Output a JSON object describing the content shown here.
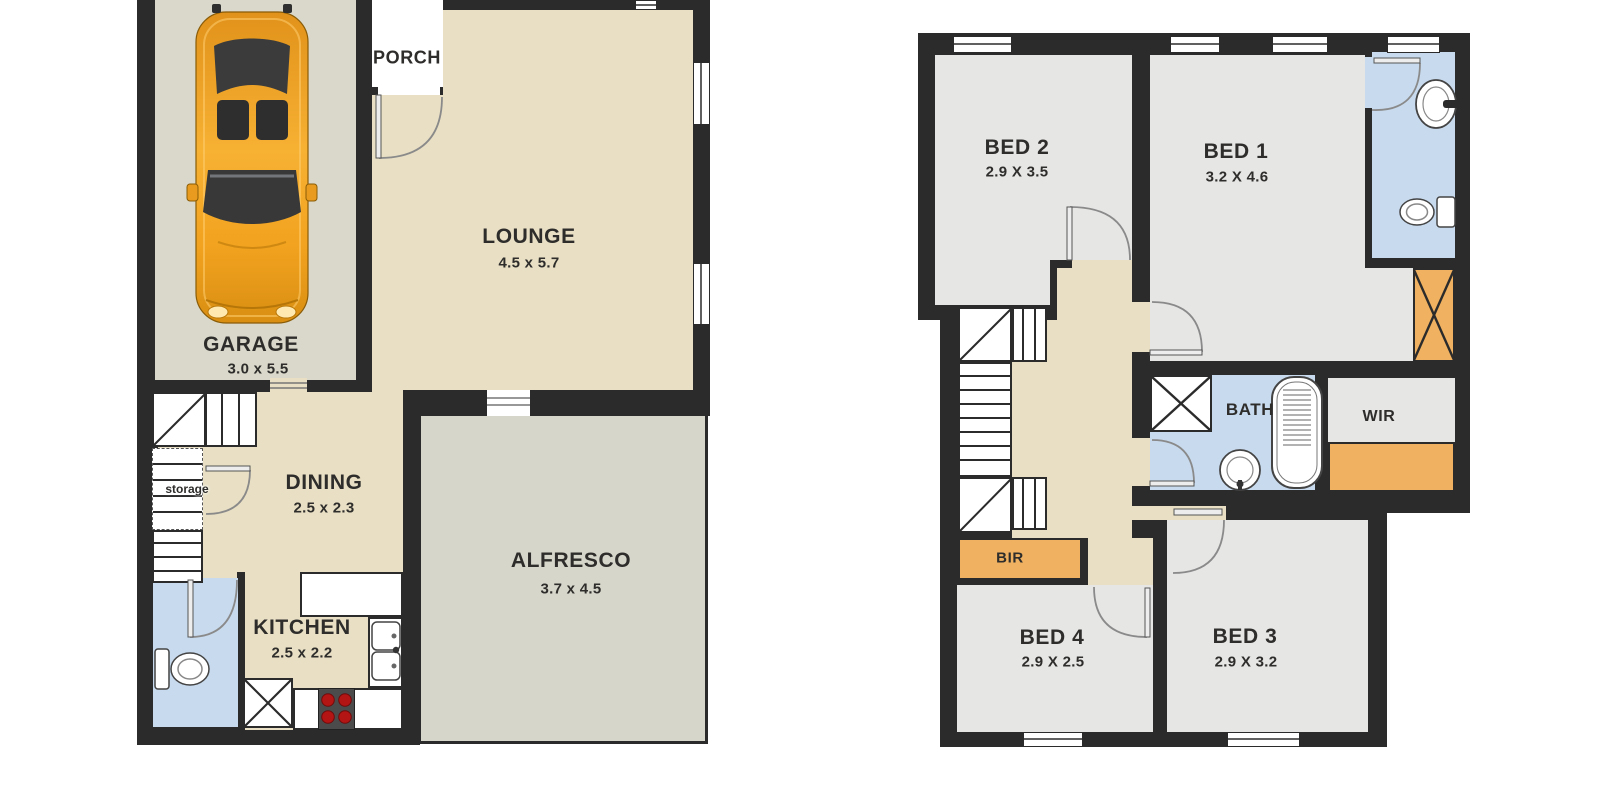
{
  "ground": {
    "garage": {
      "name": "GARAGE",
      "dims": "3.0 x 5.5"
    },
    "porch": {
      "name": "PORCH"
    },
    "lounge": {
      "name": "LOUNGE",
      "dims": "4.5 x 5.7"
    },
    "dining": {
      "name": "DINING",
      "dims": "2.5 x 2.3"
    },
    "storage": {
      "name": "storage"
    },
    "kitchen": {
      "name": "KITCHEN",
      "dims": "2.5 x 2.2"
    },
    "alfresco": {
      "name": "ALFRESCO",
      "dims": "3.7 x 4.5"
    }
  },
  "upper": {
    "bed1": {
      "name": "BED 1",
      "dims": "3.2 X 4.6"
    },
    "bed2": {
      "name": "BED 2",
      "dims": "2.9 X 3.5"
    },
    "bed3": {
      "name": "BED 3",
      "dims": "2.9 X 3.2"
    },
    "bed4": {
      "name": "BED 4",
      "dims": "2.9 X 2.5"
    },
    "bath": {
      "name": "BATH"
    },
    "wir": {
      "name": "WIR"
    },
    "bir": {
      "name": "BIR"
    }
  },
  "colors": {
    "wall": "#2b2b2b",
    "living_floor": "#e8dfc4",
    "garage_floor": "#d9d8ca",
    "alfresco_floor": "#d6d6cb",
    "bedroom_floor": "#e6e6e5",
    "wet_area": "#c8daed",
    "wardrobe": "#f0b260",
    "car_body": "#f2a31f",
    "burner": "#b31414"
  }
}
